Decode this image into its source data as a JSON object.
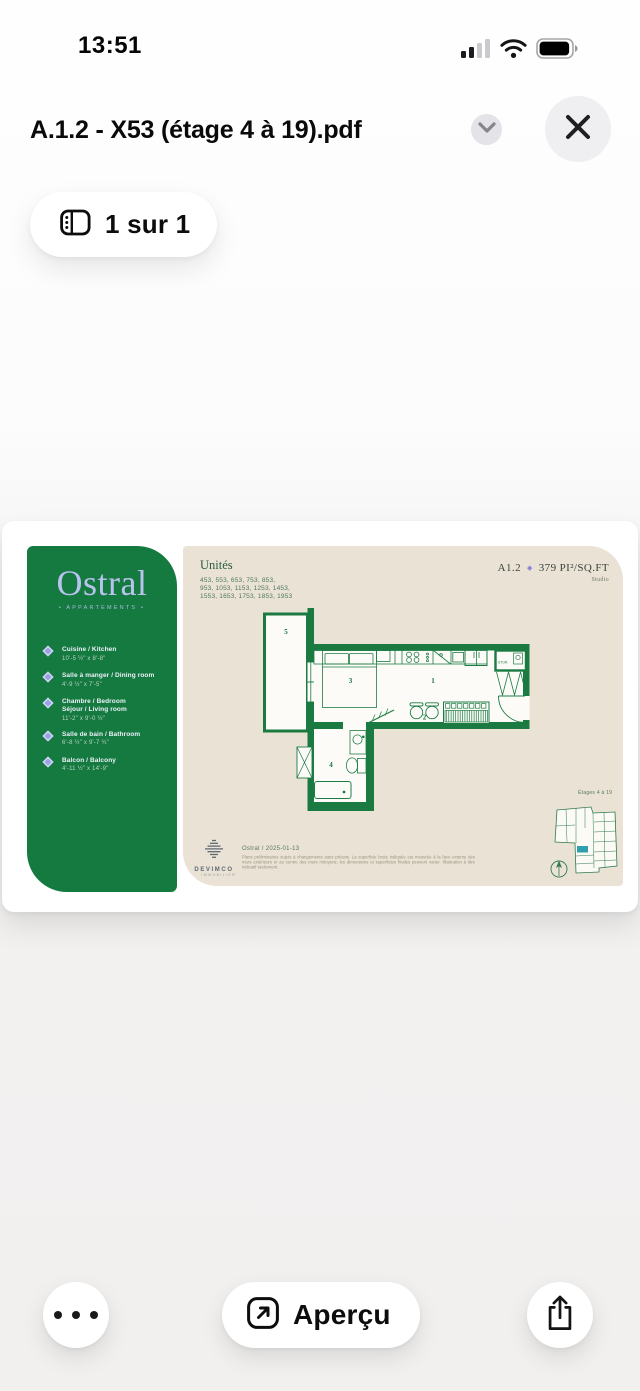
{
  "status_bar": {
    "time": "13:51"
  },
  "header": {
    "title": "A.1.2 - X53 (étage 4 à 19).pdf"
  },
  "page_indicator": {
    "label": "1 sur 1"
  },
  "pdf": {
    "brand": {
      "name": "Ostral",
      "tagline": "• APPARTEMENTS •"
    },
    "legend": [
      {
        "name": "Cuisine / Kitchen",
        "name2": "",
        "dims": "10'-5 ½\" x 8'-8\""
      },
      {
        "name": "Salle à manger / Dining room",
        "name2": "",
        "dims": "4'-9 ½\" x 7'-5\""
      },
      {
        "name": "Chambre / Bedroom",
        "name2": "Séjour / Living room",
        "dims": "11'-2\" x 9'-0 ½\""
      },
      {
        "name": "Salle de bain / Bathroom",
        "name2": "",
        "dims": "6'-8 ½\" x 9'-7 ¾\""
      },
      {
        "name": "Balcon / Balcony",
        "name2": "",
        "dims": "4'-11 ½\" x 14'-9\""
      }
    ],
    "units_title": "Unités",
    "units_lines": [
      "453, 553, 653, 753, 853,",
      "953, 1053, 1153, 1253, 1453,",
      "1553, 1653, 1753, 1853, 1953"
    ],
    "unit": {
      "code": "A1.2",
      "diamond_icon": "◆",
      "area": "379 PI²/SQ.FT",
      "type": "Studio"
    },
    "room_labels": [
      "1",
      "2",
      "3",
      "4",
      "5"
    ],
    "closet_label": "STOR.",
    "keyplan_label": "Étages 4 à 19",
    "footer": {
      "logo": "DEVIMCO",
      "logo_sub": "IMMOBILIER",
      "date_line": "Ostral / 2025-01-13",
      "disclaimer": "Plans préliminaires sujets à changements sans préavis. La superficie brute indiquée est mesurée à la face externe des murs extérieurs et au centre des murs mitoyens; les dimensions et superficies finales peuvent varier. Illustration à titre indicatif seulement."
    },
    "colors": {
      "green": "#147a3f",
      "beige": "#eae2d4",
      "lavender": "#b9c3ee",
      "purple": "#9087da",
      "keyplan_highlight": "#2f9fae"
    }
  },
  "toolbar": {
    "preview_label": "Aperçu"
  }
}
